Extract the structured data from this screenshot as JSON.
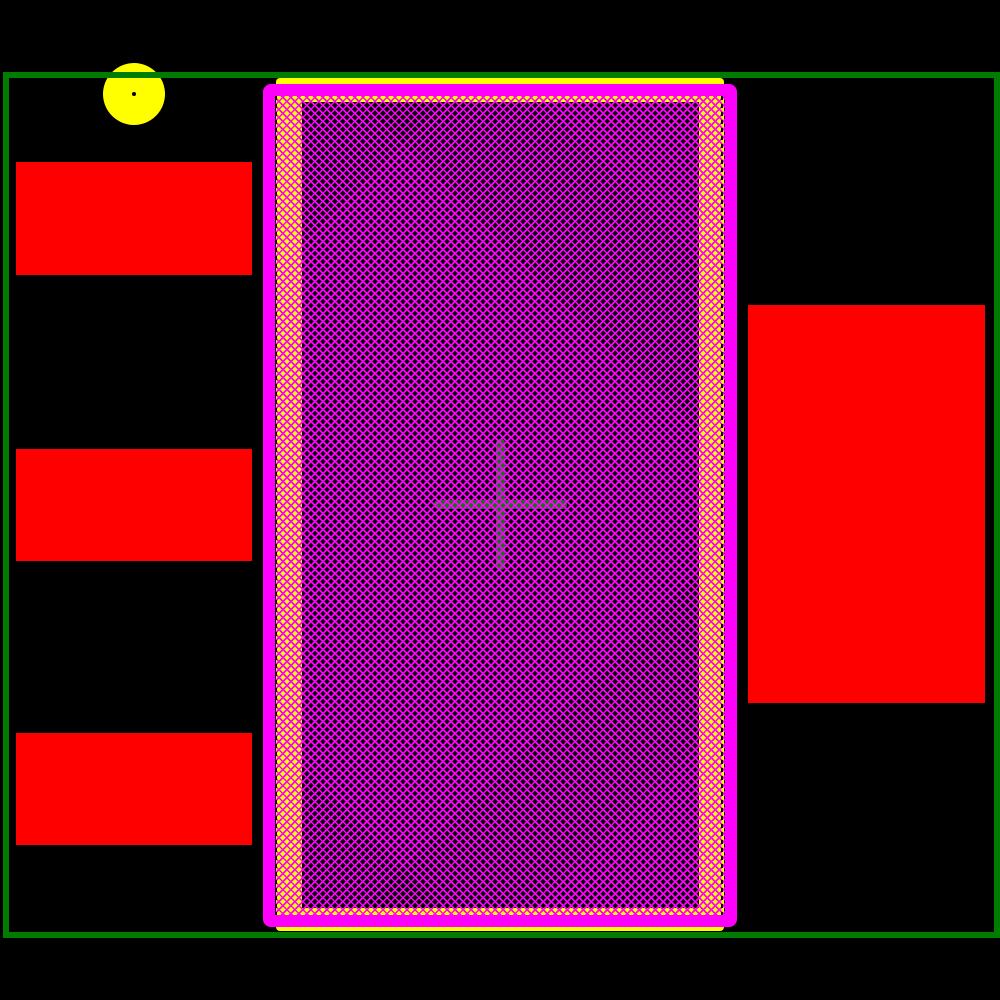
{
  "colors": {
    "background": "#000000",
    "courtyard_green": "#007C00",
    "pad_red": "#FF0000",
    "paste_yellow": "#FFFF00",
    "mask_magenta": "#FF00FF",
    "hatch_magenta": "#FF00FF",
    "copper_dark": "#000000",
    "cross_green": "#107810"
  },
  "shapes": {
    "courtyard": {
      "x": 3,
      "y": 72,
      "w": 997,
      "h": 866
    },
    "pin1_marker": {
      "x": 103,
      "y": 63,
      "w": 62,
      "h": 62
    },
    "pin1_dot": {
      "x": 132,
      "y": 92,
      "w": 4,
      "h": 4
    },
    "pads": [
      {
        "x": 16,
        "y": 162,
        "w": 236,
        "h": 113
      },
      {
        "x": 16,
        "y": 449,
        "w": 236,
        "h": 112
      },
      {
        "x": 16,
        "y": 733,
        "w": 236,
        "h": 112
      },
      {
        "x": 748,
        "y": 305,
        "w": 237,
        "h": 398
      }
    ],
    "paste_rect": {
      "x": 276,
      "y": 78,
      "w": 448,
      "h": 853
    },
    "mask_rect": {
      "x": 263,
      "y": 84,
      "w": 474,
      "h": 843
    },
    "copper_rect": {
      "x": 27,
      "y": 6,
      "w": 397,
      "h": 806
    },
    "cross_h": {
      "x": 159,
      "y": 404,
      "w": 133,
      "h": 9
    },
    "cross_v": {
      "x": 221,
      "y": 343,
      "w": 9,
      "h": 131
    },
    "hatch_overlay": {
      "x": 0,
      "y": 0,
      "w": 450,
      "h": 819
    },
    "dash_left": {
      "x": 0,
      "y": 0,
      "w": 2,
      "h": 819
    },
    "dash_right": {
      "x": 446,
      "y": 0,
      "w": 2,
      "h": 819
    }
  }
}
